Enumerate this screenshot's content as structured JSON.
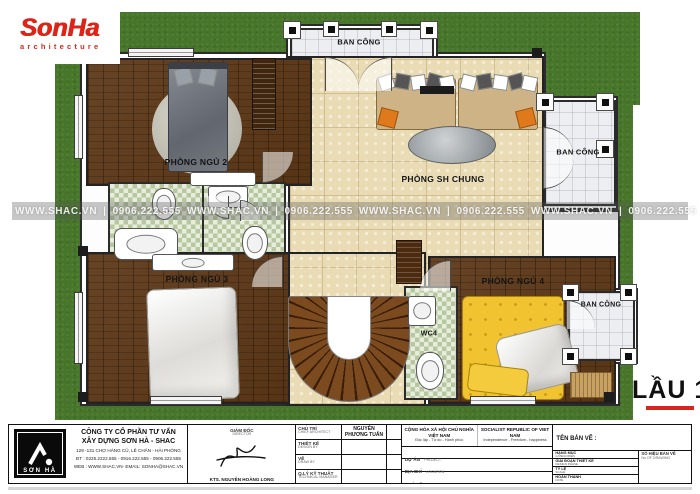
{
  "header": {
    "logo_title": "SonHa",
    "logo_subtitle": "architecture"
  },
  "floor": {
    "label": "LẦU 1"
  },
  "watermark": {
    "text": "WWW.SHAC.VN",
    "divider": "|",
    "phone": "0906.222.555"
  },
  "plan": {
    "rooms": {
      "balcony_top": "BAN CÔNG",
      "bedroom2": "PHÒNG NGỦ 2",
      "living": "PHÒNG SH CHUNG",
      "balcony_right": "BAN CÔNG",
      "bedroom3": "PHÒNG NGỦ 3",
      "wc4": "WC4",
      "bedroom4": "PHÒNG NGỦ 4",
      "balcony_bottom": "BAN CÔNG"
    }
  },
  "title_block": {
    "logo_text": "SƠN HÀ",
    "company_line1": "CÔNG TY CỔ PHẦN TƯ VẤN",
    "company_line2": "XÂY DỰNG SƠN HÀ - SHAC",
    "address": "129 -131  CHỢ HÀNG CŨ, LÊ CHÂN - HẢI PHÒNG",
    "phone": "ĐT : 0225.2222.555 - 0916.222.555 - 0906.222.555",
    "web": "WEB : WWW.SHAC.VN- EMAIL: SONHA@SHAC.VN",
    "director_label": "GIÁM ĐỐC",
    "director_label_en": "DIRECTOR",
    "architect_name": "KTS. NGUYỄN HOÀNG LONG",
    "staff": [
      {
        "label": "CHỦ TRÌ",
        "label_en": "CHIEF ARCHITECT",
        "value": "NGUYỄN PHƯƠNG TUẤN"
      },
      {
        "label": "THIẾT KẾ",
        "label_en": "DESIGN BY",
        "value": ""
      },
      {
        "label": "VẼ",
        "label_en": "DRAW BY",
        "value": ""
      },
      {
        "label": "Q.LÝ KỸ THUẬT",
        "label_en": "TECHNICAL MANAGER",
        "value": ""
      }
    ],
    "republic_vn1": "CỘNG HÒA XÃ HỘI CHỦ NGHĨA VIỆT NAM",
    "republic_vn2": "Độc lập - Tự do - Hạnh phúc",
    "republic_en1": "SOCIALIST REPUBLIC OF VIET NAM",
    "republic_en2": "Independence - Freedom - happiness",
    "project": [
      {
        "label": "DỰ ÁN",
        "label_en": "PROJECT"
      },
      {
        "label": "ĐỊA CHỈ",
        "label_en": "LOCATION"
      },
      {
        "label": "CHỦ ĐẦU TƯ",
        "label_en": "INVESTOR"
      }
    ],
    "drawing_name_label": "TÊN BẢN VẼ :",
    "details": [
      {
        "label": "HẠNG MỤC",
        "label_en": "CATEGORIES"
      },
      {
        "label": "GIAI ĐOẠN THIẾT KẾ",
        "label_en": "DESIGN PHASE"
      },
      {
        "label": "TỶ LỆ",
        "label_en": "SCALE"
      },
      {
        "label": "HOÀN THÀNH",
        "label_en": "DATE"
      }
    ],
    "drawing_no_label": "SỐ HIỆU BẢN VẼ",
    "drawing_no_en": "No OF DRAWING"
  },
  "colors": {
    "brand_red": "#dd2418",
    "grass_green": "#47762a",
    "wood_brown": "#5d3817",
    "marble_beige": "#e9dcb4",
    "underline_red": "#d82622"
  }
}
